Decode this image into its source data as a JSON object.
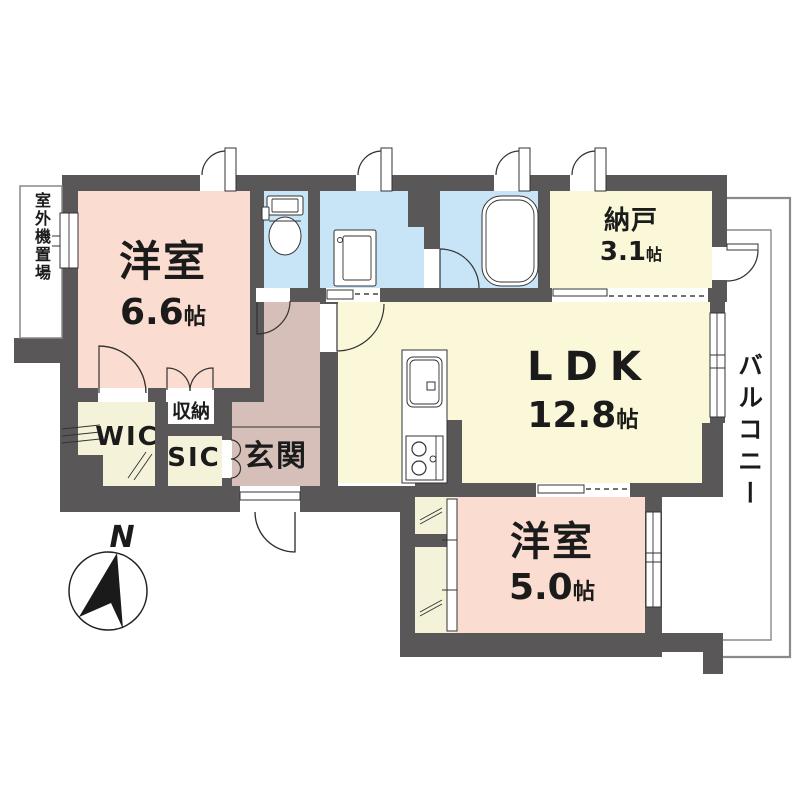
{
  "floorplan": {
    "type": "japanese-apartment-floorplan",
    "rooms": [
      {
        "id": "bedroom-1",
        "name": "洋室",
        "size": "6.6",
        "unit": "帖"
      },
      {
        "id": "ldk",
        "name": "LDK",
        "size": "12.8",
        "unit": "帖"
      },
      {
        "id": "storeroom",
        "name": "納戸",
        "size": "3.1",
        "unit": "帖"
      },
      {
        "id": "bedroom-2",
        "name": "洋室",
        "size": "5.0",
        "unit": "帖"
      }
    ],
    "areas": {
      "entrance": "玄関",
      "walk_in_closet": "WIC",
      "shoe_closet": "SIC",
      "closet": "収納",
      "balcony": "バルコニー",
      "outdoor_unit_space": "室外機置場"
    },
    "compass": {
      "north": "N"
    },
    "colors": {
      "wall": "#595757",
      "bedroom": "#fadcd1",
      "ldk_storeroom": "#faf8d8",
      "wet_area": "#c8e5f7",
      "hall_entrance": "#d5bfb8",
      "closet": "#f5f2da",
      "balcony_line": "#8a8a8a",
      "text": "#1b1b1b"
    }
  }
}
